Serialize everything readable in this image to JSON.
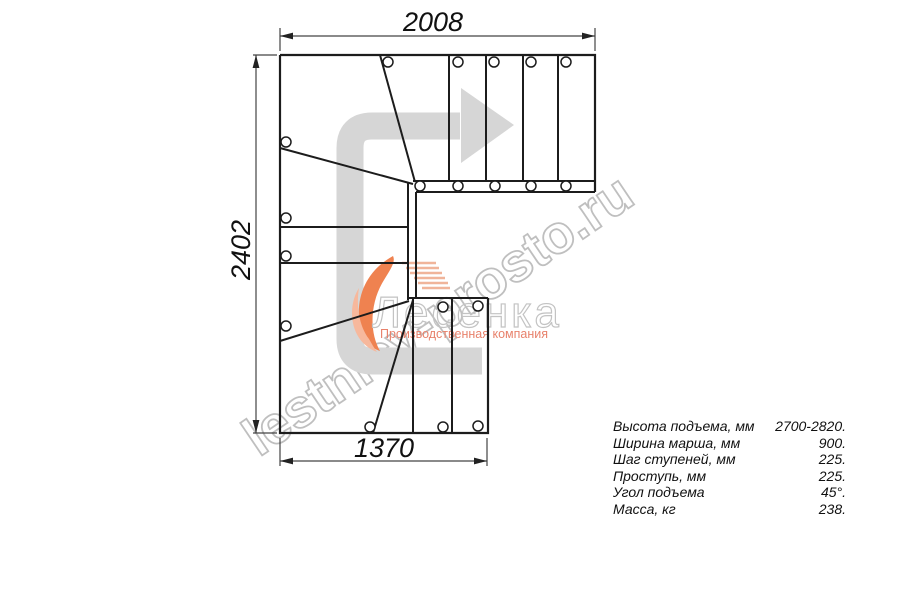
{
  "drawing": {
    "dim_top": "2008",
    "dim_left": "2402",
    "dim_bottom": "1370"
  },
  "watermark": {
    "text": "lestnicy-prosto.ru"
  },
  "logo": {
    "name": "Лесенка",
    "subtitle": "Производственная компания"
  },
  "specs": {
    "rows": [
      {
        "label": "Высота подъема, мм",
        "value": "2700-2820."
      },
      {
        "label": "Ширина марша, мм",
        "value": "900."
      },
      {
        "label": "Шаг ступеней, мм",
        "value": "225."
      },
      {
        "label": "Проступь, мм",
        "value": "225."
      },
      {
        "label": "Угол подъема",
        "value": "45°."
      },
      {
        "label": "Масса, кг",
        "value": "238."
      }
    ]
  },
  "colors": {
    "line": "#1c1c1c",
    "dimension": "#444444",
    "arrow_gray": "#d6d6d6",
    "watermark_gray": "#b5b5b5",
    "logo_gray": "#c3c3c3",
    "logo_orange": "#ef8250",
    "logo_salmon": "#e8826c"
  }
}
